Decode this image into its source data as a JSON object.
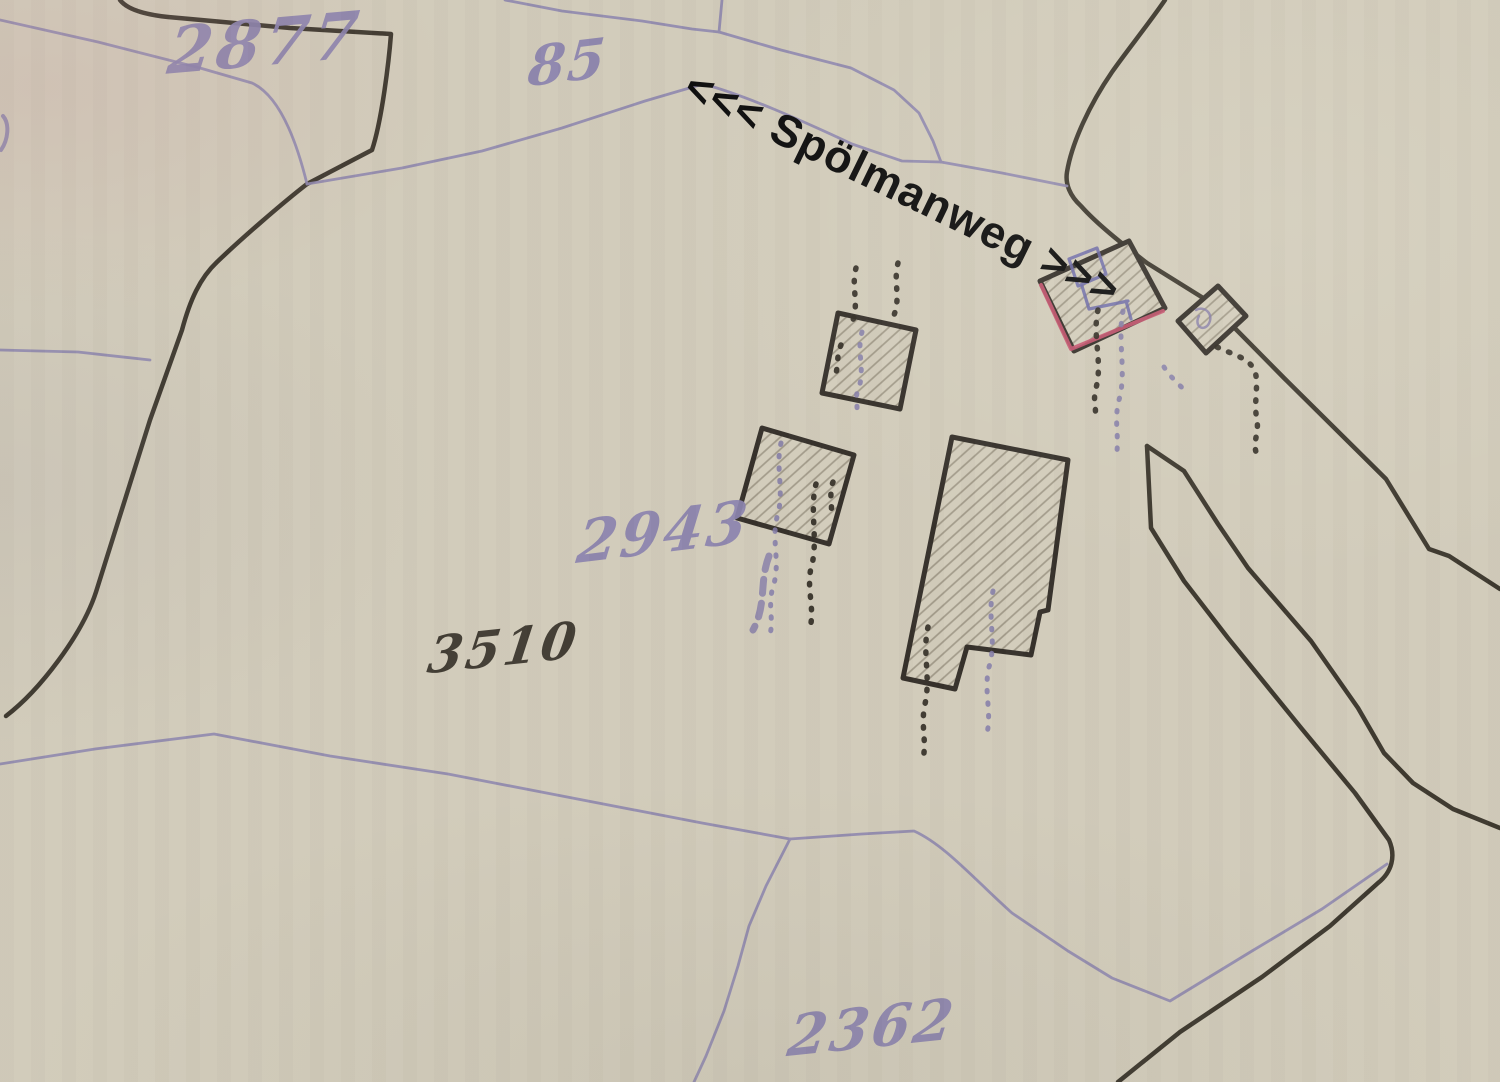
{
  "map": {
    "kind": "historical cadastral map scan",
    "road": {
      "name": "Spölmanweg",
      "annotation": "<<< Spölmanweg >>>"
    },
    "parcels": [
      {
        "label": "2877",
        "ink": "purple"
      },
      {
        "label": "85",
        "ink": "purple"
      },
      {
        "label": "2943",
        "ink": "purple"
      },
      {
        "label": "3510",
        "ink": "black"
      },
      {
        "label": "2362",
        "ink": "purple"
      }
    ],
    "buildings_count": "5",
    "colors": {
      "paper": "#d1cbba",
      "boundary_black": "#3d382e",
      "boundary_purple": "#8e87ae",
      "ink_purple": "#8a82ad",
      "ink_black": "#3a352c",
      "building_outline": "#35302a",
      "building_red": "#c5536e",
      "building_blue": "#6b68a8",
      "annotation_black": "#0c0c0c"
    }
  }
}
